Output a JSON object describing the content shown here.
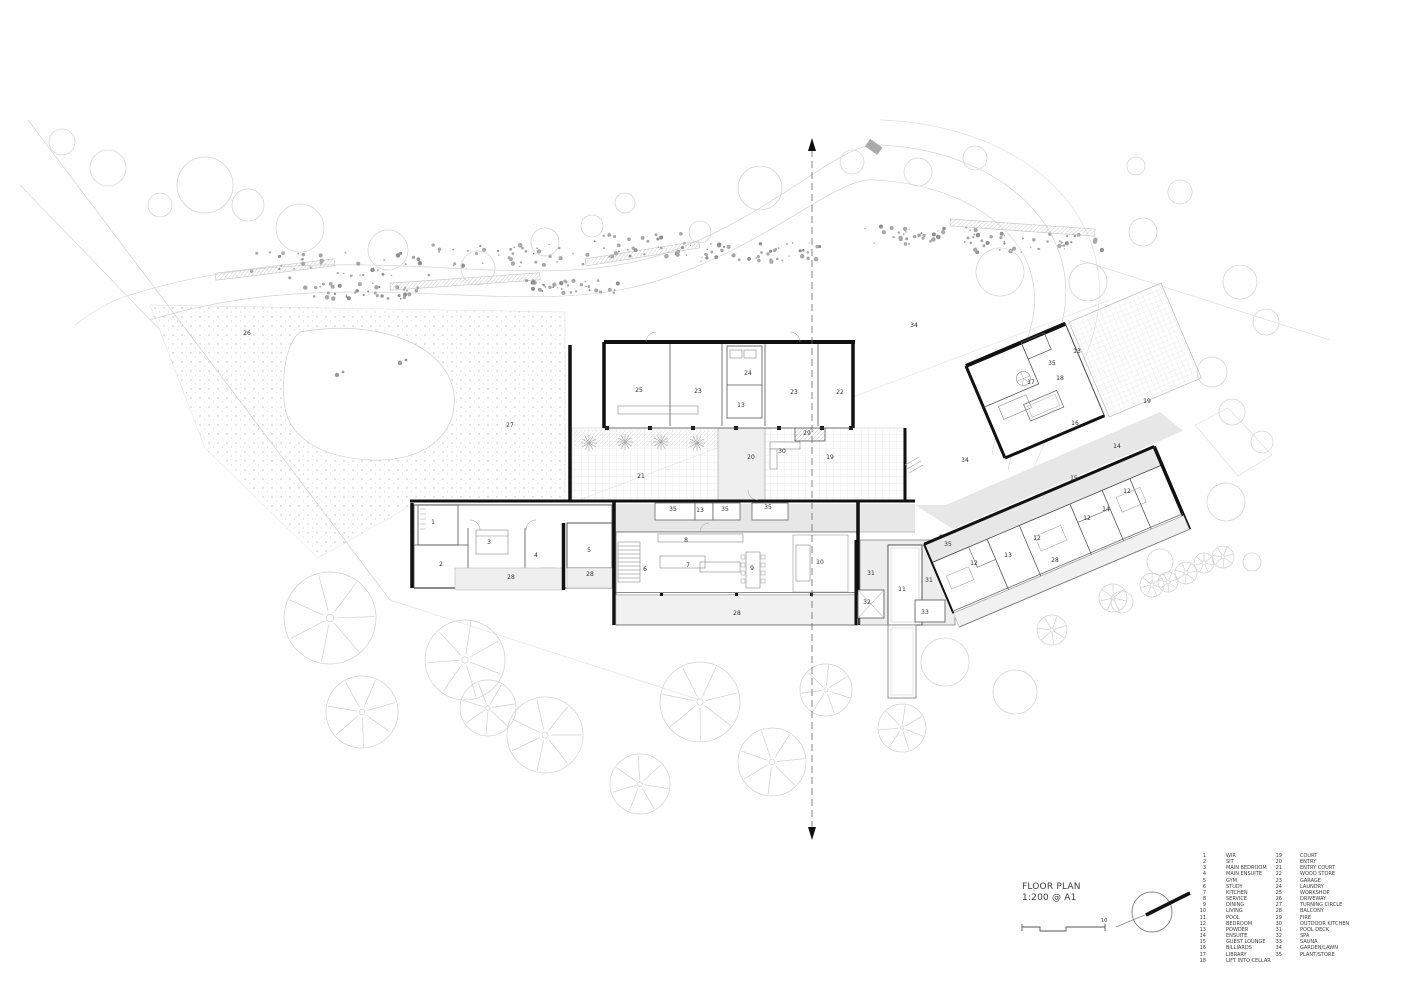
{
  "title_block": {
    "title": "FLOOR PLAN",
    "scale": "1:200 @ A1",
    "scale_bar_max": "10"
  },
  "legend": {
    "entries": [
      {
        "n": "1",
        "label": "WIR"
      },
      {
        "n": "2",
        "label": "SIT"
      },
      {
        "n": "3",
        "label": "MAIN BEDROOM"
      },
      {
        "n": "4",
        "label": "MAIN ENSUITE"
      },
      {
        "n": "5",
        "label": "GYM"
      },
      {
        "n": "6",
        "label": "STUDY"
      },
      {
        "n": "7",
        "label": "KITCHEN"
      },
      {
        "n": "8",
        "label": "SERVICE"
      },
      {
        "n": "9",
        "label": "DINING"
      },
      {
        "n": "10",
        "label": "LIVING"
      },
      {
        "n": "11",
        "label": "POOL"
      },
      {
        "n": "12",
        "label": "BEDROOM"
      },
      {
        "n": "13",
        "label": "POWDER"
      },
      {
        "n": "14",
        "label": "ENSUITE"
      },
      {
        "n": "15",
        "label": "GUEST LOUNGE"
      },
      {
        "n": "16",
        "label": "BILLIARDS"
      },
      {
        "n": "17",
        "label": "LIBRARY"
      },
      {
        "n": "18",
        "label": "LIFT INTO CELLAR"
      },
      {
        "n": "19",
        "label": "COURT"
      },
      {
        "n": "20",
        "label": "ENTRY"
      },
      {
        "n": "21",
        "label": "ENTRY COURT"
      },
      {
        "n": "22",
        "label": "WOOD STORE"
      },
      {
        "n": "23",
        "label": "GARAGE"
      },
      {
        "n": "24",
        "label": "LAUNDRY"
      },
      {
        "n": "25",
        "label": "WORKSHOP"
      },
      {
        "n": "26",
        "label": "DRIVEWAY"
      },
      {
        "n": "27",
        "label": "TURNING CIRCLE"
      },
      {
        "n": "28",
        "label": "BALCONY"
      },
      {
        "n": "29",
        "label": "FIRE"
      },
      {
        "n": "30",
        "label": "OUTDOOR KITCHEN"
      },
      {
        "n": "31",
        "label": "POOL DECK"
      },
      {
        "n": "32",
        "label": "SPA"
      },
      {
        "n": "33",
        "label": "SAUNA"
      },
      {
        "n": "34",
        "label": "GARDEN/LAWN"
      },
      {
        "n": "35",
        "label": "PLANT/STORE"
      }
    ]
  },
  "plan": {
    "labels": [
      {
        "n": "26",
        "x": 247,
        "y": 335
      },
      {
        "n": "27",
        "x": 510,
        "y": 427
      },
      {
        "n": "34",
        "x": 914,
        "y": 327
      },
      {
        "n": "34",
        "x": 965,
        "y": 462
      },
      {
        "n": "25",
        "x": 639,
        "y": 392
      },
      {
        "n": "23",
        "x": 698,
        "y": 393
      },
      {
        "n": "24",
        "x": 748,
        "y": 375
      },
      {
        "n": "13",
        "x": 741,
        "y": 407
      },
      {
        "n": "23",
        "x": 794,
        "y": 394
      },
      {
        "n": "22",
        "x": 840,
        "y": 394
      },
      {
        "n": "29",
        "x": 807,
        "y": 435
      },
      {
        "n": "30",
        "x": 782,
        "y": 453
      },
      {
        "n": "20",
        "x": 751,
        "y": 459
      },
      {
        "n": "19",
        "x": 830,
        "y": 459
      },
      {
        "n": "21",
        "x": 641,
        "y": 478
      },
      {
        "n": "1",
        "x": 433,
        "y": 524
      },
      {
        "n": "3",
        "x": 489,
        "y": 544
      },
      {
        "n": "4",
        "x": 536,
        "y": 557
      },
      {
        "n": "2",
        "x": 441,
        "y": 566
      },
      {
        "n": "28",
        "x": 511,
        "y": 579
      },
      {
        "n": "5",
        "x": 589,
        "y": 552
      },
      {
        "n": "28",
        "x": 590,
        "y": 576
      },
      {
        "n": "35",
        "x": 673,
        "y": 511
      },
      {
        "n": "13",
        "x": 700,
        "y": 512
      },
      {
        "n": "35",
        "x": 725,
        "y": 511
      },
      {
        "n": "35",
        "x": 768,
        "y": 509
      },
      {
        "n": "8",
        "x": 686,
        "y": 542
      },
      {
        "n": "6",
        "x": 645,
        "y": 571
      },
      {
        "n": "7",
        "x": 688,
        "y": 567
      },
      {
        "n": "9",
        "x": 752,
        "y": 570
      },
      {
        "n": "10",
        "x": 820,
        "y": 564
      },
      {
        "n": "28",
        "x": 737,
        "y": 615
      },
      {
        "n": "31",
        "x": 871,
        "y": 575
      },
      {
        "n": "32",
        "x": 867,
        "y": 604
      },
      {
        "n": "11",
        "x": 902,
        "y": 591
      },
      {
        "n": "31",
        "x": 929,
        "y": 582
      },
      {
        "n": "33",
        "x": 925,
        "y": 614
      },
      {
        "n": "35",
        "x": 948,
        "y": 546
      },
      {
        "n": "12",
        "x": 974,
        "y": 565
      },
      {
        "n": "13",
        "x": 1008,
        "y": 557
      },
      {
        "n": "28",
        "x": 1055,
        "y": 562
      },
      {
        "n": "12",
        "x": 1037,
        "y": 540
      },
      {
        "n": "14",
        "x": 1106,
        "y": 511
      },
      {
        "n": "12",
        "x": 1087,
        "y": 520
      },
      {
        "n": "12",
        "x": 1127,
        "y": 493
      },
      {
        "n": "15",
        "x": 1074,
        "y": 480
      },
      {
        "n": "14",
        "x": 1117,
        "y": 448
      },
      {
        "n": "16",
        "x": 1075,
        "y": 425
      },
      {
        "n": "17",
        "x": 1031,
        "y": 384
      },
      {
        "n": "35",
        "x": 1052,
        "y": 365
      },
      {
        "n": "13",
        "x": 1077,
        "y": 353
      },
      {
        "n": "18",
        "x": 1060,
        "y": 380
      },
      {
        "n": "19",
        "x": 1147,
        "y": 403
      }
    ]
  },
  "colors": {
    "wall": "#111111",
    "landscape_line": "#d4d4d4",
    "corridor_fill": "#e7e7e7",
    "label_text": "#2e2e2e"
  }
}
